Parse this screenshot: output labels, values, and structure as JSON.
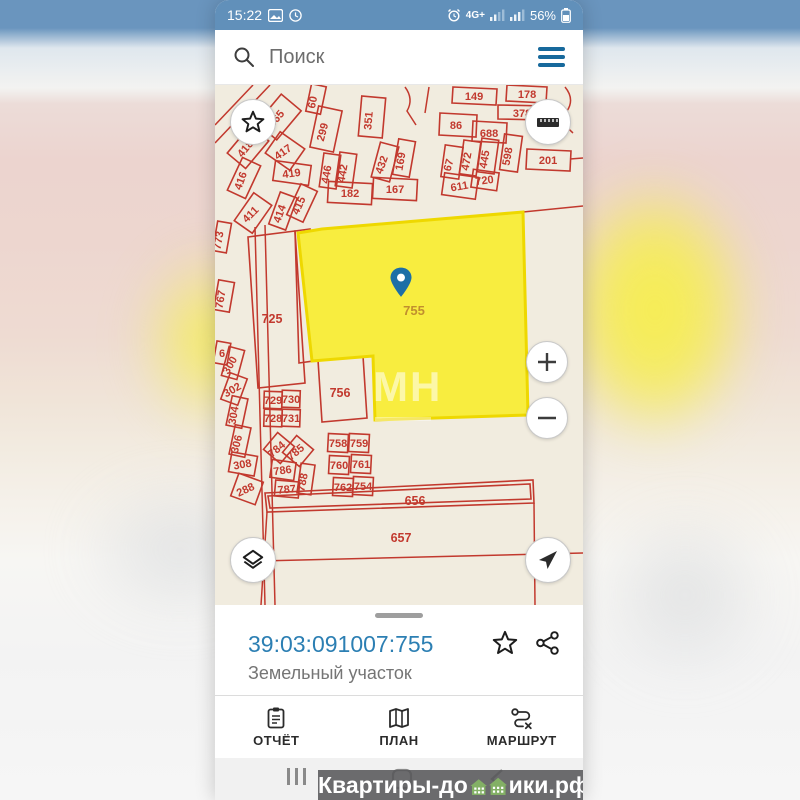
{
  "colors": {
    "status_bar_bg": "#6190ba",
    "accent_blue": "#2c7fb3",
    "parcel_red": "#c2392e",
    "selected_yellow": "#f8ed3f",
    "map_bg": "#f1ecdf",
    "pin_blue": "#1d6fa6",
    "menu_blue": "#17699c",
    "house_green": "#83b065"
  },
  "status_bar": {
    "time": "15:22",
    "network": "4G+",
    "battery": "56%"
  },
  "search": {
    "placeholder": "Поиск"
  },
  "map": {
    "watermark": "МН",
    "selected": {
      "points": "83,148 107,144 308,127 313,330 160,335 158,271 97,276",
      "label": "755",
      "label_x": 199,
      "label_y": 230
    },
    "red_shapes": [
      "238,2 282,4 281,20 237,18",
      "292,0 332,2 331,18 291,16",
      "283,20 332,21 331,35 283,34",
      "225,28 262,30 261,52 224,50",
      "258,36 292,38 291,58 257,56",
      "312,64 356,66 355,86 311,84",
      "33,152 80,146 90,298 43,303",
      "80,146 95,144 98,276 84,278",
      "103,275 148,271 152,333 107,337",
      "50,408 318,395 319,418 52,427",
      "53,411 315,399 316,414 55,423"
    ],
    "red_lines": [
      [
        0,
        58,
        55,
        0
      ],
      [
        0,
        40,
        38,
        0
      ],
      [
        308,
        127,
        368,
        121
      ],
      [
        355,
        74,
        368,
        73
      ],
      [
        52,
        427,
        46,
        520
      ],
      [
        319,
        418,
        320,
        520
      ],
      [
        45,
        476,
        368,
        468
      ],
      [
        40,
        142,
        50,
        520
      ],
      [
        50,
        140,
        60,
        520
      ]
    ],
    "red_paths": [
      "M350,2 q10,12 2,24 q-8,10 6,22",
      "M190,2 q9,12 2,24 l9,14",
      "M214,2 l-4,26"
    ],
    "parcels": [
      {
        "label": "60",
        "x": 101,
        "y": 14,
        "w": 15,
        "h": 28,
        "r": 12,
        "rl": -78
      },
      {
        "label": "365",
        "x": 64,
        "y": 32,
        "w": 26,
        "h": 38,
        "r": 40,
        "rl": -50
      },
      {
        "label": "299",
        "x": 111,
        "y": 44,
        "w": 24,
        "h": 42,
        "r": 12,
        "rl": -75
      },
      {
        "label": "351",
        "x": 157,
        "y": 32,
        "w": 24,
        "h": 40,
        "r": 5,
        "rl": -85
      },
      {
        "label": "149",
        "x": 259,
        "y": 11
      },
      {
        "label": "178",
        "x": 312,
        "y": 9
      },
      {
        "label": "378",
        "x": 307,
        "y": 28
      },
      {
        "label": "86",
        "x": 241,
        "y": 40
      },
      {
        "label": "688",
        "x": 274,
        "y": 48
      },
      {
        "label": "201",
        "x": 333,
        "y": 75
      },
      {
        "label": "418",
        "x": 33,
        "y": 62,
        "w": 24,
        "h": 36,
        "r": 40,
        "rl": -50
      },
      {
        "label": "417",
        "x": 70,
        "y": 66,
        "w": 30,
        "h": 26,
        "r": 35,
        "rl": -35
      },
      {
        "label": "419",
        "x": 77,
        "y": 88,
        "w": 36,
        "h": 20,
        "r": 8,
        "rl": -8
      },
      {
        "label": "416",
        "x": 29,
        "y": 93,
        "w": 20,
        "h": 36,
        "r": 25,
        "rl": -70
      },
      {
        "label": "446",
        "x": 115,
        "y": 86,
        "w": 17,
        "h": 34,
        "r": 8,
        "rl": -80
      },
      {
        "label": "442",
        "x": 131,
        "y": 85,
        "w": 17,
        "h": 34,
        "r": 8,
        "rl": -80
      },
      {
        "label": "432",
        "x": 170,
        "y": 77,
        "w": 19,
        "h": 36,
        "r": 15,
        "rl": -70
      },
      {
        "label": "169",
        "x": 189,
        "y": 73,
        "w": 17,
        "h": 36,
        "r": 10,
        "rl": -80
      },
      {
        "label": "67",
        "x": 237,
        "y": 77,
        "w": 18,
        "h": 32,
        "r": 8,
        "rl": -75
      },
      {
        "label": "472",
        "x": 255,
        "y": 73,
        "w": 17,
        "h": 34,
        "r": 8,
        "rl": -80
      },
      {
        "label": "445",
        "x": 273,
        "y": 71,
        "w": 17,
        "h": 34,
        "r": 8,
        "rl": -80
      },
      {
        "label": "598",
        "x": 296,
        "y": 68,
        "w": 18,
        "h": 36,
        "r": 8,
        "rl": -80
      },
      {
        "label": "182",
        "x": 135,
        "y": 108,
        "w": 44,
        "h": 21,
        "r": 3,
        "rl": 0
      },
      {
        "label": "167",
        "x": 180,
        "y": 104,
        "w": 44,
        "h": 21,
        "r": 3,
        "rl": 0
      },
      {
        "label": "611",
        "x": 245,
        "y": 101,
        "w": 34,
        "h": 22,
        "r": 8,
        "rl": -10
      },
      {
        "label": "720",
        "x": 270,
        "y": 95,
        "w": 26,
        "h": 18,
        "r": 8,
        "rl": -8
      },
      {
        "label": "415",
        "x": 87,
        "y": 118,
        "w": 18,
        "h": 34,
        "r": 25,
        "rl": -65
      },
      {
        "label": "414",
        "x": 68,
        "y": 126,
        "w": 18,
        "h": 34,
        "r": 20,
        "rl": -70
      },
      {
        "label": "411",
        "x": 38,
        "y": 128,
        "w": 22,
        "h": 34,
        "r": 35,
        "rl": -45
      },
      {
        "label": "773",
        "x": 7,
        "y": 152,
        "w": 14,
        "h": 30,
        "r": 10,
        "rl": -80
      },
      {
        "label": "767",
        "x": 9,
        "y": 211,
        "w": 16,
        "h": 30,
        "r": 10,
        "rl": -80
      },
      {
        "label": "725",
        "x": 57,
        "y": 234,
        "big": true
      },
      {
        "label": "6",
        "x": 7,
        "y": 268,
        "w": 14,
        "h": 22,
        "r": 10,
        "rl": 0
      },
      {
        "label": "300",
        "x": 18,
        "y": 278,
        "w": 16,
        "h": 30,
        "r": 15,
        "rl": -60
      },
      {
        "label": "302",
        "x": 19,
        "y": 304,
        "w": 18,
        "h": 28,
        "r": 20,
        "rl": -30
      },
      {
        "label": "304",
        "x": 22,
        "y": 327,
        "w": 16,
        "h": 30,
        "r": 12,
        "rl": -80
      },
      {
        "label": "306",
        "x": 25,
        "y": 356,
        "w": 16,
        "h": 30,
        "r": 12,
        "rl": -75
      },
      {
        "label": "308",
        "x": 28,
        "y": 379,
        "w": 26,
        "h": 20,
        "r": 10,
        "rl": -10
      },
      {
        "label": "288",
        "x": 32,
        "y": 404,
        "w": 26,
        "h": 24,
        "r": 20,
        "rl": -25
      },
      {
        "label": "729",
        "x": 58,
        "y": 315,
        "w": 18,
        "h": 17,
        "r": 2,
        "rl": 0
      },
      {
        "label": "730",
        "x": 76,
        "y": 314,
        "w": 18,
        "h": 17,
        "r": 2,
        "rl": 0
      },
      {
        "label": "728",
        "x": 58,
        "y": 333,
        "w": 18,
        "h": 17,
        "r": 2,
        "rl": 0
      },
      {
        "label": "731",
        "x": 76,
        "y": 333,
        "w": 18,
        "h": 17,
        "r": 2,
        "rl": 0
      },
      {
        "label": "784",
        "x": 64,
        "y": 363,
        "w": 22,
        "h": 22,
        "r": 40,
        "rl": -40
      },
      {
        "label": "785",
        "x": 83,
        "y": 366,
        "w": 22,
        "h": 22,
        "r": 40,
        "rl": -40
      },
      {
        "label": "786",
        "x": 68,
        "y": 385,
        "w": 24,
        "h": 18,
        "r": 8,
        "rl": -8
      },
      {
        "label": "787",
        "x": 72,
        "y": 404,
        "w": 24,
        "h": 16,
        "r": 5,
        "rl": -5
      },
      {
        "label": "788",
        "x": 91,
        "y": 394,
        "w": 14,
        "h": 30,
        "r": 8,
        "rl": -78
      },
      {
        "label": "756",
        "x": 125,
        "y": 308,
        "big": true
      },
      {
        "label": "758",
        "x": 123,
        "y": 358,
        "w": 20,
        "h": 18,
        "r": 3,
        "rl": 0
      },
      {
        "label": "759",
        "x": 144,
        "y": 358,
        "w": 20,
        "h": 18,
        "r": 3,
        "rl": 0
      },
      {
        "label": "760",
        "x": 124,
        "y": 380,
        "w": 20,
        "h": 18,
        "r": 3,
        "rl": 0
      },
      {
        "label": "761",
        "x": 146,
        "y": 379,
        "w": 20,
        "h": 18,
        "r": 3,
        "rl": 0
      },
      {
        "label": "762",
        "x": 128,
        "y": 402,
        "w": 20,
        "h": 18,
        "r": 3,
        "rl": 0
      },
      {
        "label": "754",
        "x": 148,
        "y": 401,
        "w": 20,
        "h": 18,
        "r": 3,
        "rl": 0
      },
      {
        "label": "656",
        "x": 200,
        "y": 416,
        "big": true
      },
      {
        "label": "657",
        "x": 186,
        "y": 453,
        "big": true
      }
    ]
  },
  "bottom_sheet": {
    "cadastral_number": "39:03:091007:755",
    "subtitle": "Земельный участок"
  },
  "tab_bar": {
    "items": [
      {
        "label": "ОТЧЁТ"
      },
      {
        "label": "ПЛАН"
      },
      {
        "label": "МАРШРУТ"
      }
    ]
  },
  "watermark": {
    "left": "Квартиры-до",
    "right": "ики.рф"
  }
}
